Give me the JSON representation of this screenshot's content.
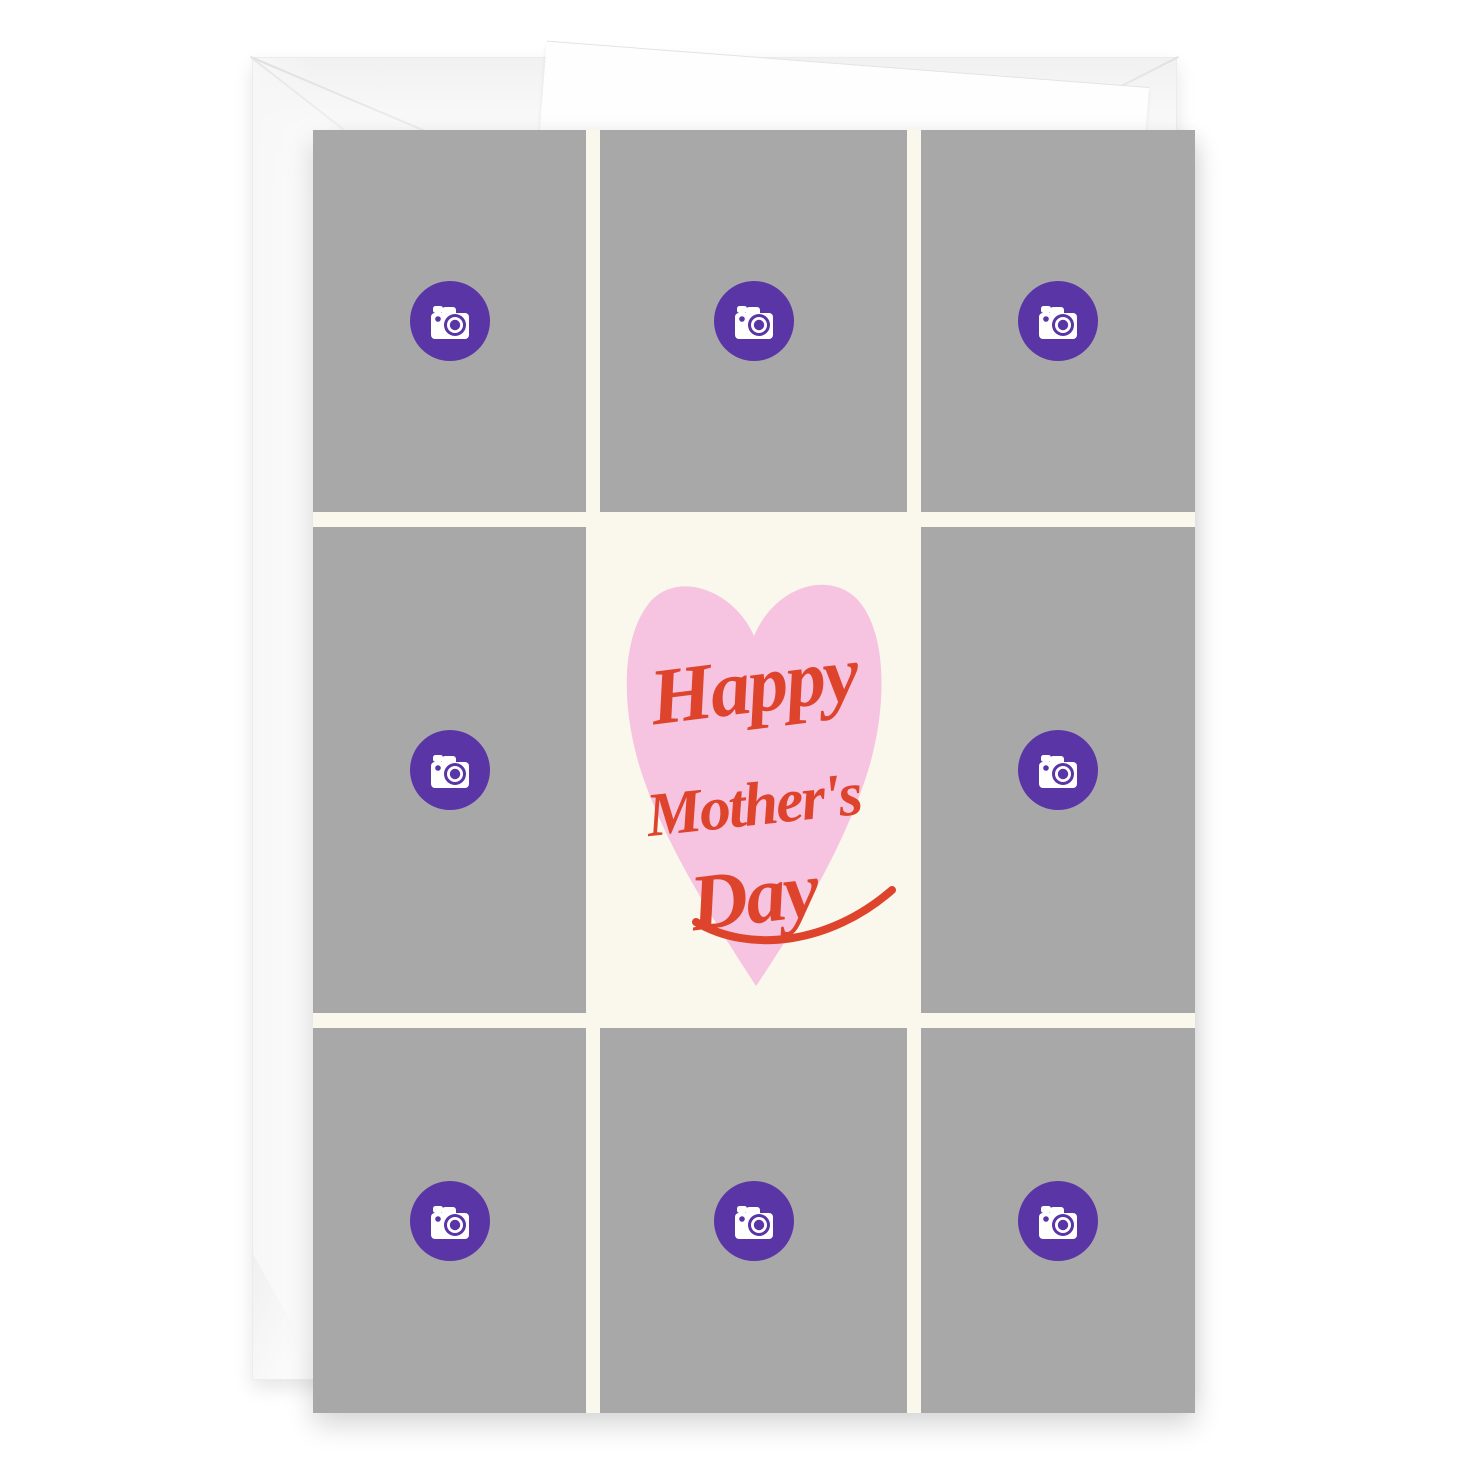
{
  "page": {
    "background_color": "#ffffff"
  },
  "envelope": {
    "color": "#fcfcfc",
    "description": "white envelope with open flap behind card"
  },
  "card": {
    "background_color": "#faf7ed",
    "photo_tile_color": "#a8a8a8",
    "camera_button_color": "#5a35a5",
    "heart_color": "#f6c3e0",
    "greeting_color": "#de432c",
    "greeting": {
      "line1": "Happy",
      "line2": "Mother's",
      "line3": "Day"
    },
    "photo_slots": {
      "count": 8,
      "icon": "camera-icon"
    }
  }
}
